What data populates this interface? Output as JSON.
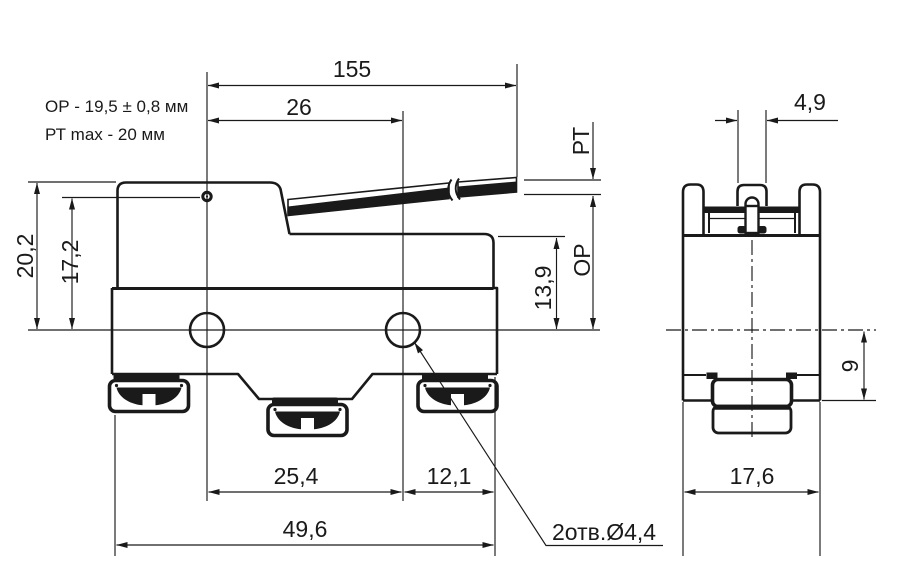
{
  "drawing": {
    "type": "technical-drawing",
    "subject": "micro limit switch with long hinge lever — front and side views",
    "notes": {
      "op": "ОР - 19,5 ± 0,8 мм",
      "pt": "РТ max - 20 мм"
    },
    "front_view": {
      "dim_lever_total": "155",
      "dim_pivot_to_hole": "26",
      "dim_height_total": "20,2",
      "dim_height_pivot": "17,2",
      "dim_pt_label": "РТ",
      "dim_op_label": "ОР",
      "dim_top_to_center": "13,9",
      "dim_hole_spacing": "25,4",
      "dim_hole_to_edge": "12,1",
      "dim_body_width": "49,6",
      "holes_note": "2отв.Ø4,4"
    },
    "side_view": {
      "dim_plunger_width": "4,9",
      "dim_center_to_bottom": "9",
      "dim_body_depth": "17,6"
    },
    "colors": {
      "line": "#1a1a1a",
      "background": "#ffffff"
    }
  }
}
